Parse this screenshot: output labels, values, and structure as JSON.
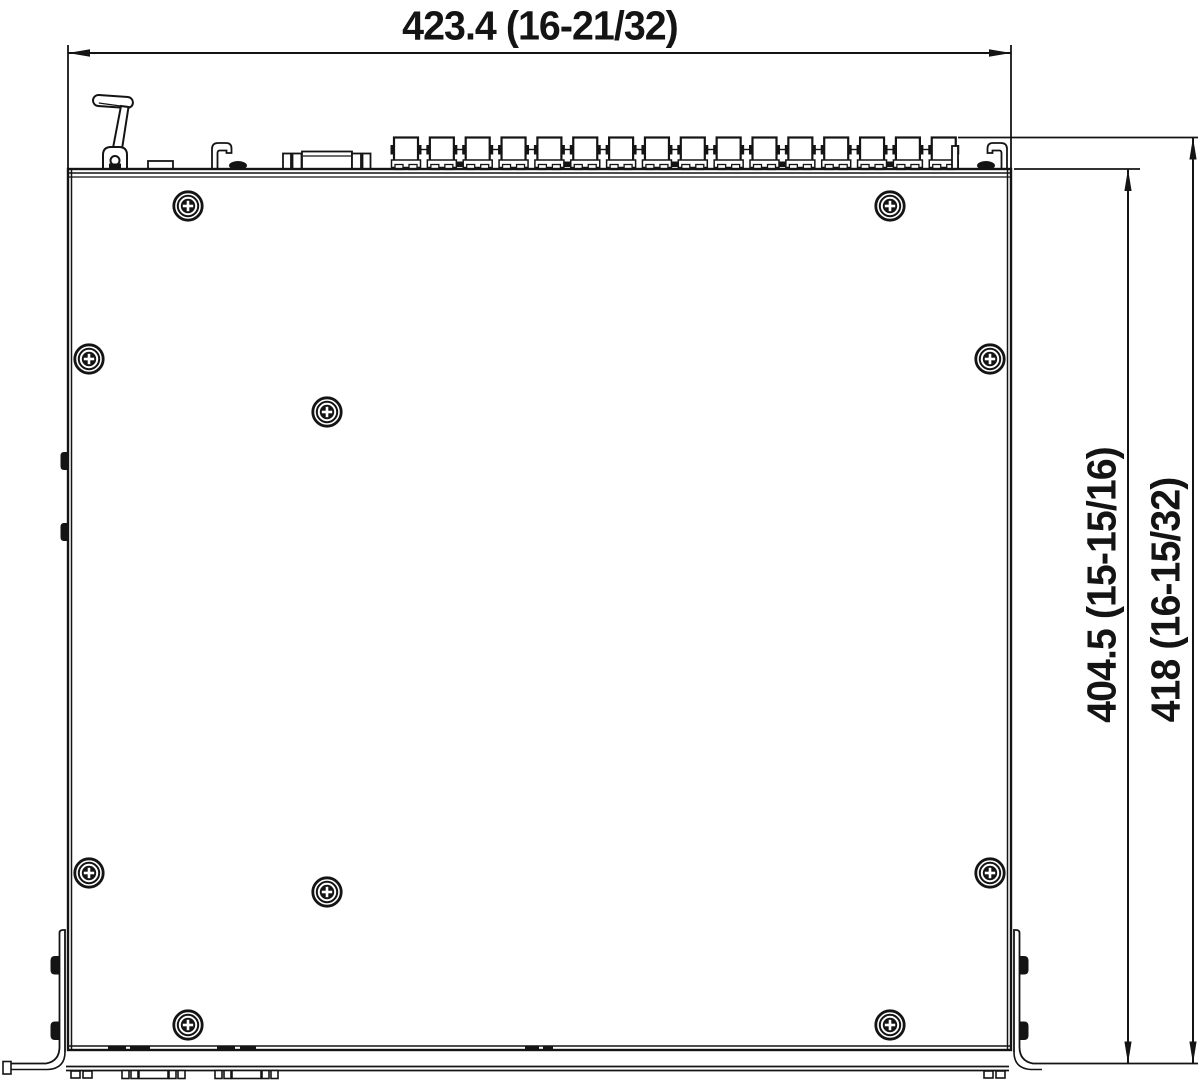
{
  "drawing": {
    "type": "technical-dimension-drawing-top-view",
    "background_color": "#ffffff",
    "line_color": "#141414",
    "labels": {
      "width": "423.4 (16-21/32)",
      "depth_chassis": "404.5 (15-15/16)",
      "depth_overall": "418 (16-15/32)"
    },
    "screw_positions": [
      [
        188,
        206
      ],
      [
        890,
        206
      ],
      [
        89,
        359
      ],
      [
        990,
        359
      ],
      [
        327,
        412
      ],
      [
        89,
        873
      ],
      [
        990,
        873
      ],
      [
        327,
        892
      ],
      [
        188,
        1025
      ],
      [
        890,
        1025
      ]
    ],
    "rear_connectors": {
      "count": 16,
      "start_x": 394,
      "spacing": 35.85,
      "top_y": 137.5,
      "body_width": 24,
      "body_height": 26.5
    }
  }
}
